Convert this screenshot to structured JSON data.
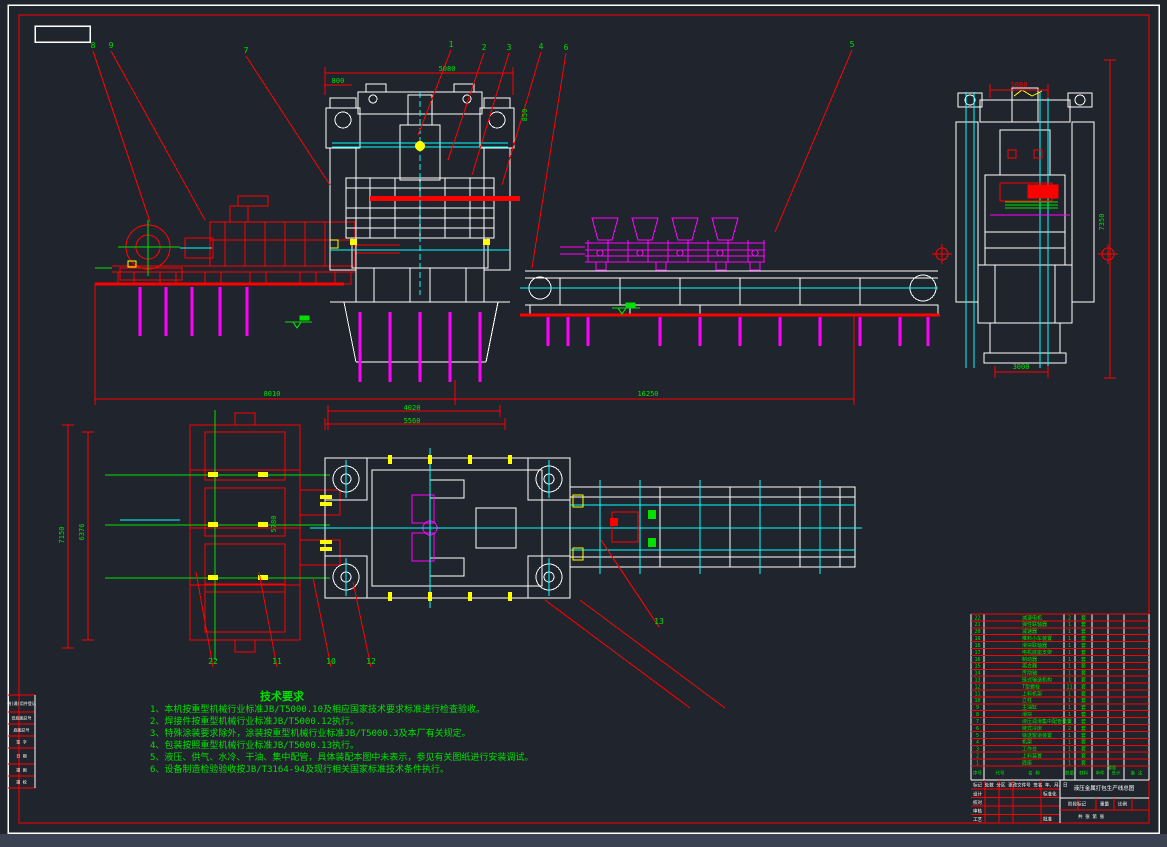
{
  "colors": {
    "background": "#20252d",
    "outer_strip": "#3a4150",
    "line_white": "#ffffff",
    "line_red": "#ff0000",
    "line_cyan": "#00ffff",
    "line_magenta": "#ff00ff",
    "line_yellow": "#ffff00",
    "text_green": "#00e000"
  },
  "notes": {
    "title": "技术要求",
    "items": [
      "1、本机按重型机械行业标准JB/T5000.10及相应国家技术要求标准进行检查验收。",
      "2、焊接件按重型机械行业标准JB/T5000.12执行。",
      "3、特殊涂装要求除外，涂装按重型机械行业标准JB/T5000.3及本厂有关规定。",
      "4、包装按照重型机械行业标准JB/T5000.13执行。",
      "5、液压、供气、水冷、干油、集中配管，具体装配本图中未表示，参见有关图纸进行安装调试。",
      "6、设备制造检验验收按JB/T3164-94及现行相关国家标准技术条件执行。"
    ]
  },
  "callouts": [
    {
      "n": "8",
      "x": 93,
      "y": 48,
      "lx": 150,
      "ly": 222
    },
    {
      "n": "9",
      "x": 111,
      "y": 48,
      "lx": 205,
      "ly": 220
    },
    {
      "n": "7",
      "x": 246,
      "y": 53,
      "lx": 330,
      "ly": 185
    },
    {
      "n": "1",
      "x": 451,
      "y": 47,
      "lx": 418,
      "ly": 135
    },
    {
      "n": "2",
      "x": 484,
      "y": 50,
      "lx": 448,
      "ly": 160
    },
    {
      "n": "3",
      "x": 509,
      "y": 50,
      "lx": 472,
      "ly": 175
    },
    {
      "n": "4",
      "x": 541,
      "y": 49,
      "lx": 502,
      "ly": 185
    },
    {
      "n": "6",
      "x": 566,
      "y": 50,
      "lx": 532,
      "ly": 268
    },
    {
      "n": "5",
      "x": 852,
      "y": 47,
      "lx": 775,
      "ly": 232
    },
    {
      "n": "22",
      "x": 213,
      "y": 664,
      "lx": 196,
      "ly": 572
    },
    {
      "n": "11",
      "x": 277,
      "y": 664,
      "lx": 259,
      "ly": 572
    },
    {
      "n": "10",
      "x": 331,
      "y": 664,
      "lx": 313,
      "ly": 578
    },
    {
      "n": "12",
      "x": 371,
      "y": 664,
      "lx": 353,
      "ly": 582
    },
    {
      "n": "13",
      "x": 659,
      "y": 624,
      "lx": 601,
      "ly": 540
    }
  ],
  "dimensions": [
    {
      "t": "5080",
      "x": 447,
      "y": 71,
      "rot": 0,
      "c": "green"
    },
    {
      "t": "800",
      "x": 338,
      "y": 83,
      "rot": 0,
      "c": "green"
    },
    {
      "t": "850",
      "x": 527,
      "y": 115,
      "rot": -90,
      "c": "green"
    },
    {
      "t": "1080",
      "x": 1019,
      "y": 87,
      "rot": 0,
      "c": "red"
    },
    {
      "t": "7350",
      "x": 1104,
      "y": 222,
      "rot": -90,
      "c": "green"
    },
    {
      "t": "3000",
      "x": 1021,
      "y": 369,
      "rot": 0,
      "c": "green"
    },
    {
      "t": "8010",
      "x": 272,
      "y": 396,
      "rot": 0,
      "c": "green"
    },
    {
      "t": "16250",
      "x": 648,
      "y": 396,
      "rot": 0,
      "c": "green"
    },
    {
      "t": "4020",
      "x": 412,
      "y": 410,
      "rot": 0,
      "c": "green"
    },
    {
      "t": "5560",
      "x": 412,
      "y": 423,
      "rot": 0,
      "c": "green"
    },
    {
      "t": "7150",
      "x": 64,
      "y": 535,
      "rot": -90,
      "c": "green"
    },
    {
      "t": "6376",
      "x": 84,
      "y": 532,
      "rot": -90,
      "c": "green"
    },
    {
      "t": "5780",
      "x": 276,
      "y": 524,
      "rot": -90,
      "c": "green"
    }
  ],
  "bom": {
    "headers": [
      "序号",
      "代号",
      "名 称",
      "数量",
      "材料",
      "单件",
      "总计",
      "备 注"
    ],
    "weight_label": "重量",
    "rows": [
      [
        "22",
        "",
        "减速电机",
        "2",
        "套"
      ],
      [
        "21",
        "",
        "弹性联轴器",
        "1",
        "套"
      ],
      [
        "20",
        "",
        "减速器",
        "1",
        "套"
      ],
      [
        "19",
        "",
        "推料小车装置",
        "1",
        "套"
      ],
      [
        "18",
        "",
        "滑块联轴器",
        "1",
        "套"
      ],
      [
        "17",
        "",
        "电机底座支架",
        "1",
        "套"
      ],
      [
        "16",
        "",
        "制动器",
        "1",
        "套"
      ],
      [
        "15",
        "",
        "离合器",
        "1",
        "套"
      ],
      [
        "14",
        "",
        "传动轴",
        "1",
        "套"
      ],
      [
        "13",
        "",
        "链式输送机构",
        "1",
        "套"
      ],
      [
        "12",
        "",
        "T型螺栓",
        "11",
        "套"
      ],
      [
        "11",
        "",
        "上料机架",
        "1",
        "套"
      ],
      [
        "10",
        "",
        "立柱",
        "1",
        "套"
      ],
      [
        "9",
        "",
        "主油缸",
        "1",
        "套"
      ],
      [
        "8",
        "",
        "滑块",
        "1",
        "套"
      ],
      [
        "7",
        "",
        "液压润滑集中配管装置",
        "1",
        "套"
      ],
      [
        "6",
        "",
        "链式冷床",
        "2",
        "套"
      ],
      [
        "5",
        "",
        "输送辊道装置",
        "1",
        "套"
      ],
      [
        "4",
        "",
        "机架",
        "1",
        "套"
      ],
      [
        "3",
        "",
        "工作台",
        "1",
        "套"
      ],
      [
        "2",
        "",
        "上料装置",
        "1",
        "套"
      ],
      [
        "1",
        "",
        "底座",
        "1",
        "套"
      ]
    ]
  },
  "title_block": {
    "revision_row": "标记 处数 分区 更改文件号 签名 年、月、日",
    "left_rows": [
      "设计",
      "校对",
      "审核",
      "工艺"
    ],
    "approve_label": "批准",
    "standard_label": "标准化",
    "stage_label": "阶段标记",
    "weight_label": "重量",
    "scale_label": "比例",
    "sheet_label": "共 张 第 张",
    "drawing_title": "液压金属打包生产线总图"
  },
  "edge_strip": [
    "借(通)用件登记",
    "旧底图总号",
    "底图总号",
    "签 字",
    "日 期",
    "描 图",
    "描 校"
  ]
}
